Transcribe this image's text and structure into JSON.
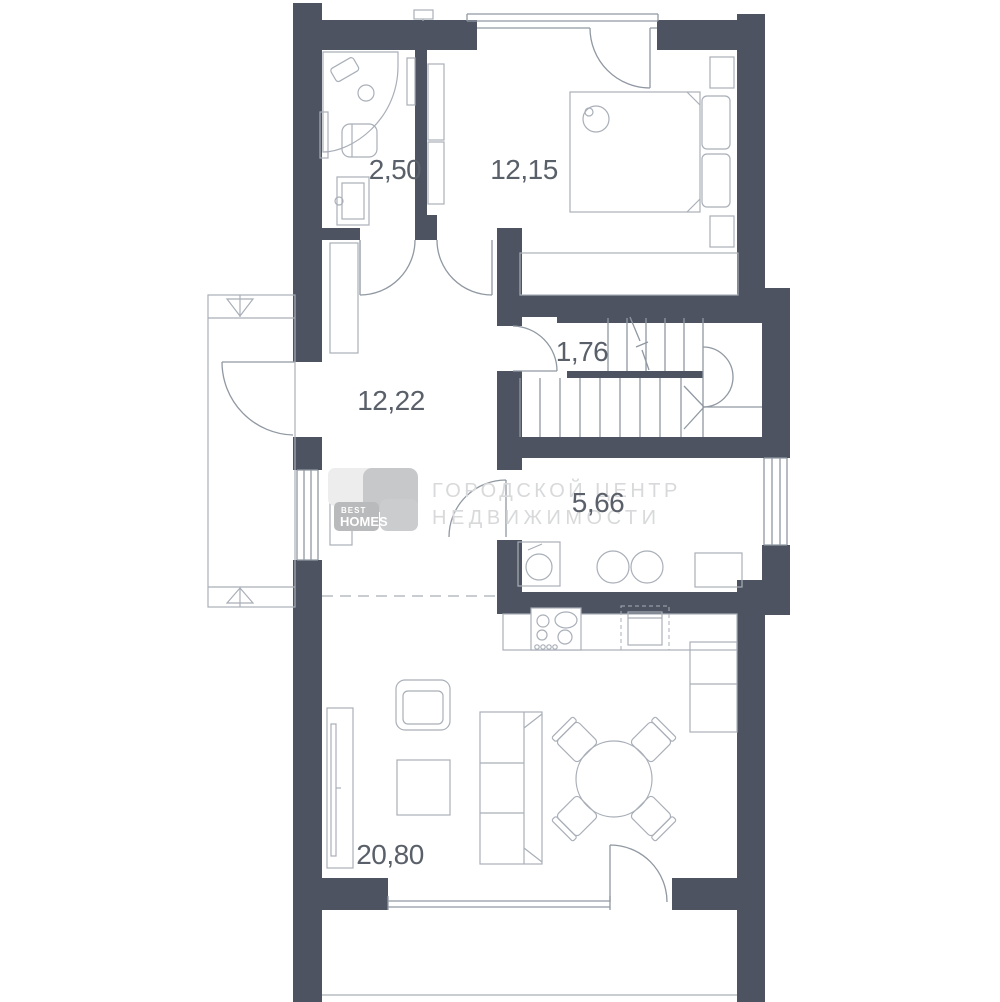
{
  "plan": {
    "title": "apartment-floor-plan",
    "rooms": [
      {
        "name": "bathroom",
        "area_label": "2,50"
      },
      {
        "name": "bedroom",
        "area_label": "12,15"
      },
      {
        "name": "stair-hall",
        "area_label": "1,76"
      },
      {
        "name": "hallway",
        "area_label": "12,22"
      },
      {
        "name": "kitchen",
        "area_label": "5,66"
      },
      {
        "name": "living-room",
        "area_label": "20,80"
      }
    ]
  },
  "watermark": {
    "logo_top": "BEST",
    "logo_bottom": "HOMES",
    "line1": "ГОРОДСКОЙ ЦЕНТР",
    "line2": "НЕДВИЖИМОСТИ"
  },
  "colors": {
    "wall": "#4d5360",
    "thin_line": "#9098a2",
    "furniture_line": "#a9afb8",
    "label": "#5a6069",
    "watermark": "#d8d9da",
    "logo_grays": [
      "#ededee",
      "#c7c8c9",
      "#b9babb",
      "#cbccce"
    ]
  }
}
